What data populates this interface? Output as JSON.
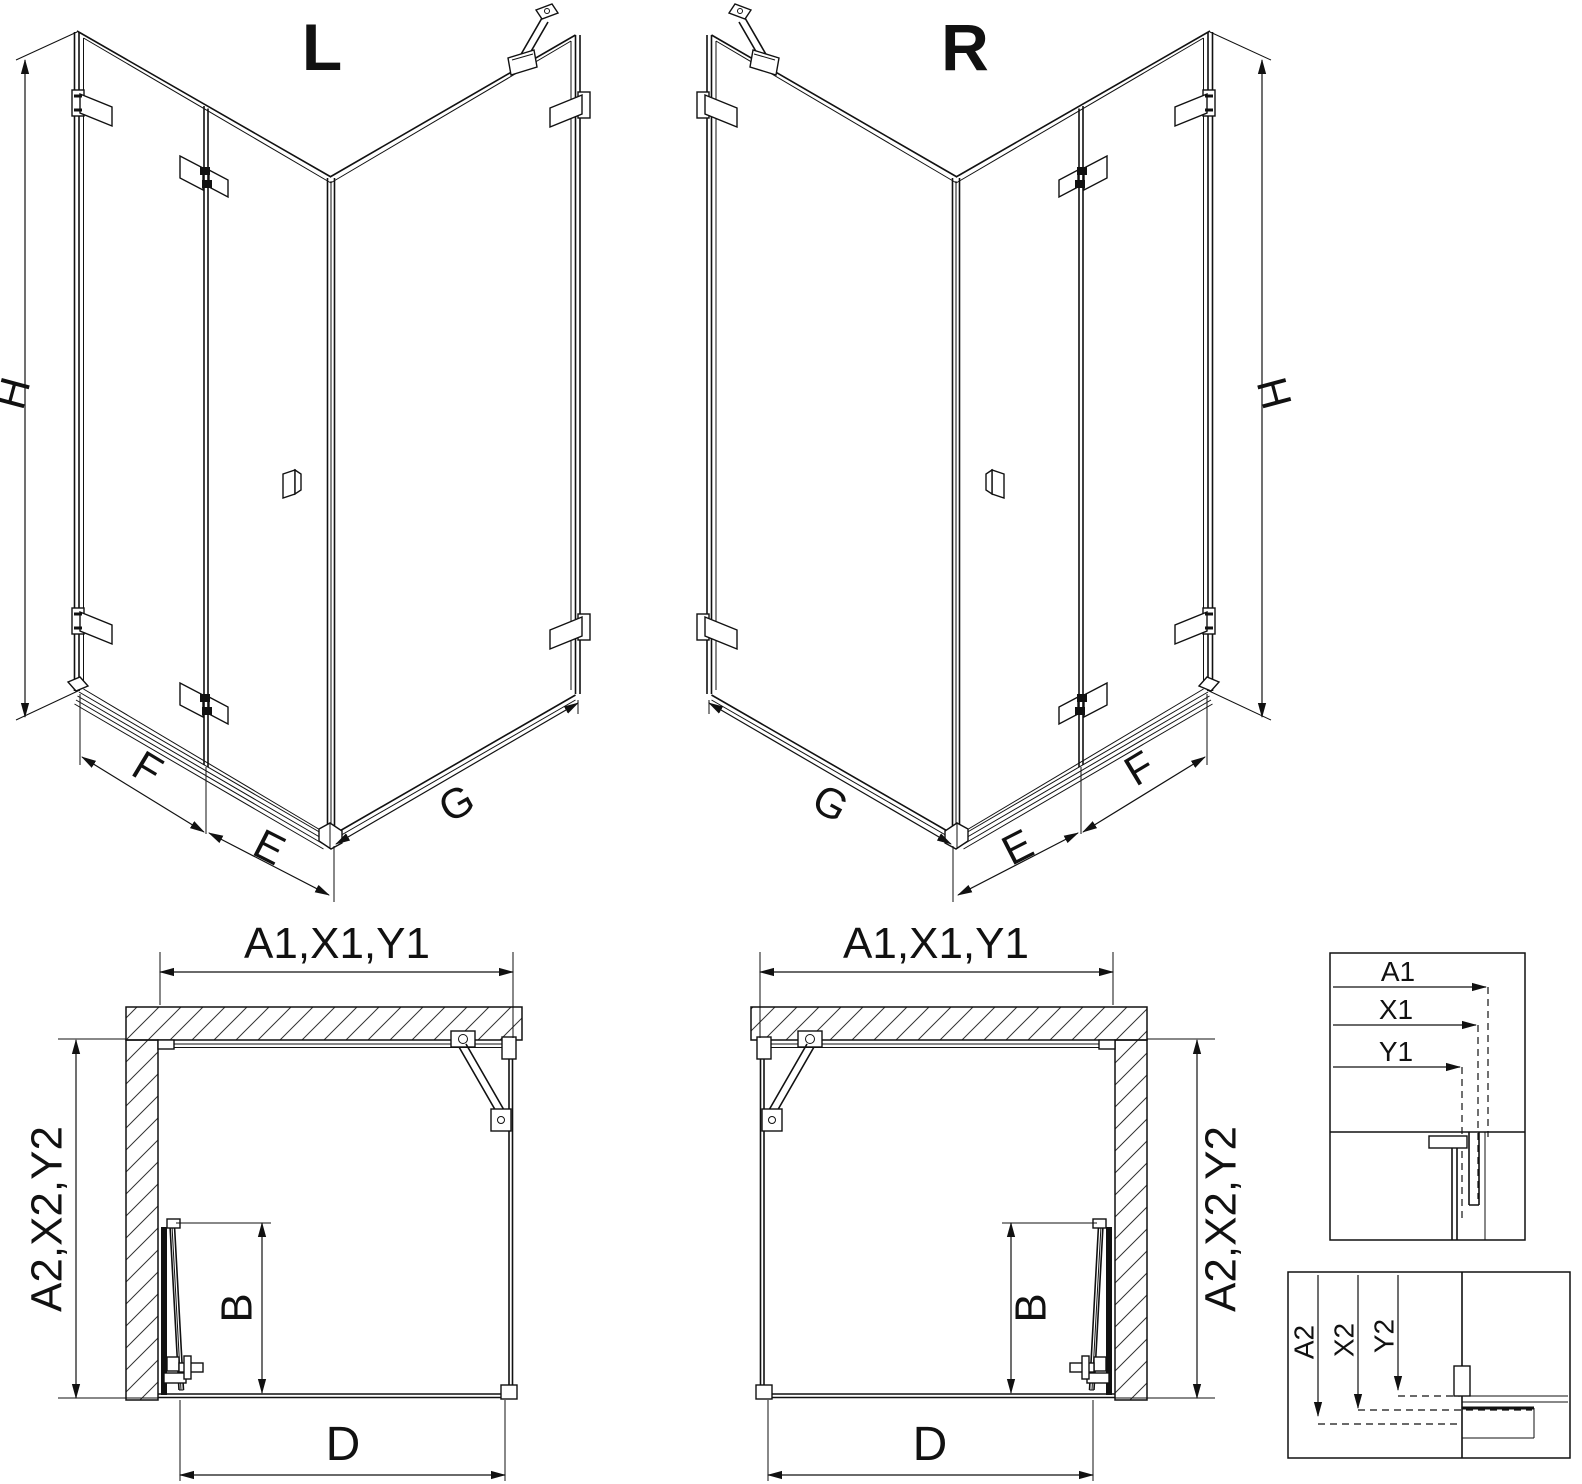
{
  "colors": {
    "background": "#ffffff",
    "line": "#111111"
  },
  "iso": {
    "left": {
      "variant": "L",
      "height": "H",
      "panel_f": "F",
      "panel_e": "E",
      "panel_g": "G"
    },
    "right": {
      "variant": "R",
      "height": "H",
      "panel_f": "F",
      "panel_e": "E",
      "panel_g": "G"
    }
  },
  "plan": {
    "left": {
      "width": "A1,X1,Y1",
      "depth": "A2,X2,Y2",
      "door": "B",
      "opening": "D"
    },
    "right": {
      "width": "A1,X1,Y1",
      "depth": "A2,X2,Y2",
      "door": "B",
      "opening": "D"
    }
  },
  "details": {
    "width_inset": {
      "a1": "A1",
      "x1": "X1",
      "y1": "Y1"
    },
    "depth_inset": {
      "a2": "A2",
      "x2": "X2",
      "y2": "Y2"
    }
  }
}
